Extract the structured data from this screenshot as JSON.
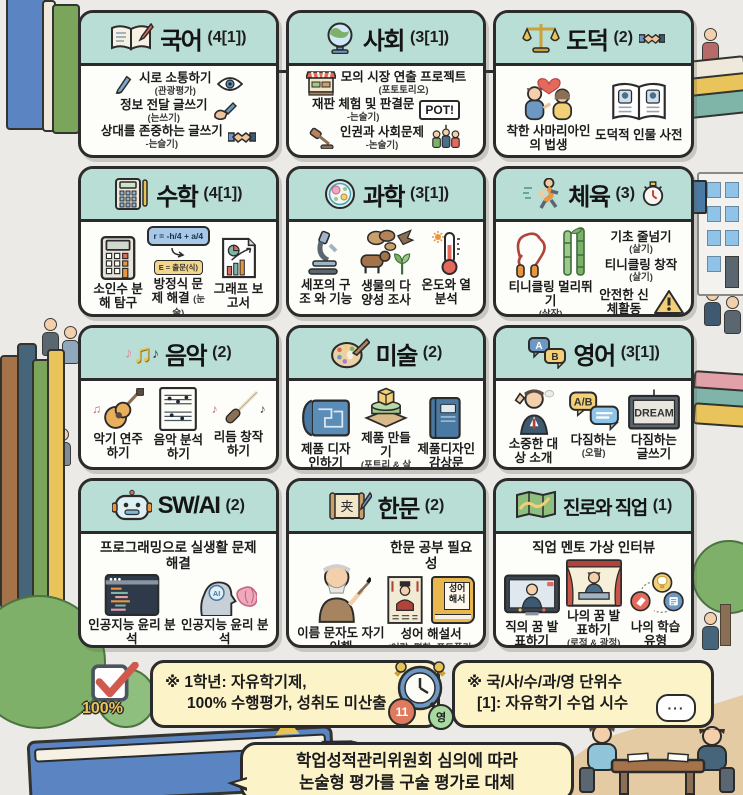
{
  "colors": {
    "bg": "#eceae6",
    "card_header_teal": "#b9ded6",
    "card_border": "#2b2b2b",
    "note_yellow": "#fdf3c9",
    "accent_red": "#e2695c",
    "accent_green": "#7fb069",
    "accent_blue": "#6d98c4"
  },
  "glyphs": {
    "note_a": "♪",
    "note_b": "♫",
    "dots": "···"
  },
  "cards": [
    {
      "title": "국어",
      "count": "(4[1])",
      "items": [
        {
          "label": "시로 소통하기",
          "sub": "(관광평가)"
        },
        {
          "label": "정보 전달 글쓰기",
          "sub": "(는쓰기)"
        },
        {
          "label": "상대를 존중하는 글쓰기",
          "sub": "-는슬기)"
        }
      ]
    },
    {
      "title": "사회",
      "count": "(3[1])",
      "sign": "POT!",
      "items": [
        {
          "label": "모의 시장 연출 프로젝트",
          "sub": "(포토토리오)"
        },
        {
          "label": "재판 체험 및 판결문",
          "sub": "-는술기)"
        },
        {
          "label": "인권과 사회문제",
          "sub": "-논술기)"
        }
      ]
    },
    {
      "title": "도덕",
      "count": "(2)",
      "items": [
        {
          "label": "착한 사마리아인의 법생"
        },
        {
          "label": "도덕적 인물 사전"
        }
      ]
    },
    {
      "title": "수학",
      "count": "(4[1])",
      "formula_main": "r = -h/4 + a/4",
      "formula_sub": "E = 출문(식)",
      "items": [
        {
          "label": "소인수 분해 탐구"
        },
        {
          "label": "방정식 문제 해결",
          "sub": "(눈술)"
        },
        {
          "label": "그래프 보고서"
        }
      ]
    },
    {
      "title": "과학",
      "count": "(3[1])",
      "items": [
        {
          "label": "세포의 구조 와 기능"
        },
        {
          "label": "생물의 다양성 조사"
        },
        {
          "label": "온도와 열 분석"
        }
      ]
    },
    {
      "title": "체육",
      "count": "(3)",
      "items": [
        {
          "label": "티니클링 멀리뛰기",
          "sub": "(살작)"
        },
        {
          "label": "기초 줄넘기",
          "sub": "(살기)"
        },
        {
          "label": "티니클링 창작",
          "sub": "(살기)"
        },
        {
          "label": "안전한 신체활동"
        }
      ]
    },
    {
      "title": "음악",
      "count": "(2)",
      "items": [
        {
          "label": "악기 연주하기"
        },
        {
          "label": "음악 분석하기"
        },
        {
          "label": "리듬 창작하기"
        }
      ]
    },
    {
      "title": "미술",
      "count": "(2)",
      "items": [
        {
          "label": "제품 디자인하기"
        },
        {
          "label": "제품 만들기",
          "sub": "(포트리 & 살작)"
        },
        {
          "label": "제품디자인 감상문"
        }
      ]
    },
    {
      "title": "영어",
      "count": "(3[1])",
      "bubble_a": "A",
      "bubble_b": "B",
      "bubble_ab": "A/B",
      "board_text": "DREAM",
      "items": [
        {
          "label": "소중한 대상 소개"
        },
        {
          "label": "다짐하는",
          "sub": "(오랄)"
        },
        {
          "label": "다짐하는 글쓰기"
        }
      ]
    },
    {
      "title": "SW/AI",
      "count": "(2)",
      "top": "프로그래밍으로 실생활 문제 해결",
      "ai_badge": "AI",
      "items": [
        {
          "label": "인공지능 윤리 분석"
        },
        {
          "label": "인공지능 윤리 분석"
        }
      ]
    },
    {
      "title": "한문",
      "count": "(2)",
      "top": "한문 공부 필요성",
      "scroll_char": "夹",
      "book_text": "성어\n해서",
      "items": [
        {
          "label": "이름 문자도 자기 이해"
        },
        {
          "label": "성어 해설서",
          "sub": "(어랄, 평창, 포트폴리)"
        }
      ]
    },
    {
      "title": "진로와 직업",
      "count": "(1)",
      "top": "직업 멘토 가상 인터뷰",
      "items": [
        {
          "label": "직의 꿈 발표하기"
        },
        {
          "label": "나의 꿈 발표하기",
          "sub": "(로적 & 광정)"
        },
        {
          "label": "나의 학습 유형"
        }
      ]
    }
  ],
  "notes": {
    "note1": {
      "line1": "※ 1학년: 자유학기제,",
      "line2": "100% 수행평가, 성취도 미산출",
      "badge": "100%"
    },
    "note2": {
      "line1": "※ 국/사/수/과/영 단위수",
      "line2": "[1]: 자유학기 수업 시수",
      "badge_left": "11",
      "badge_right": "영"
    },
    "note3": {
      "line1": "학업성적관리위원회 심의에 따라",
      "line2": "논술형 평가를 구술 평가로 대체"
    }
  }
}
